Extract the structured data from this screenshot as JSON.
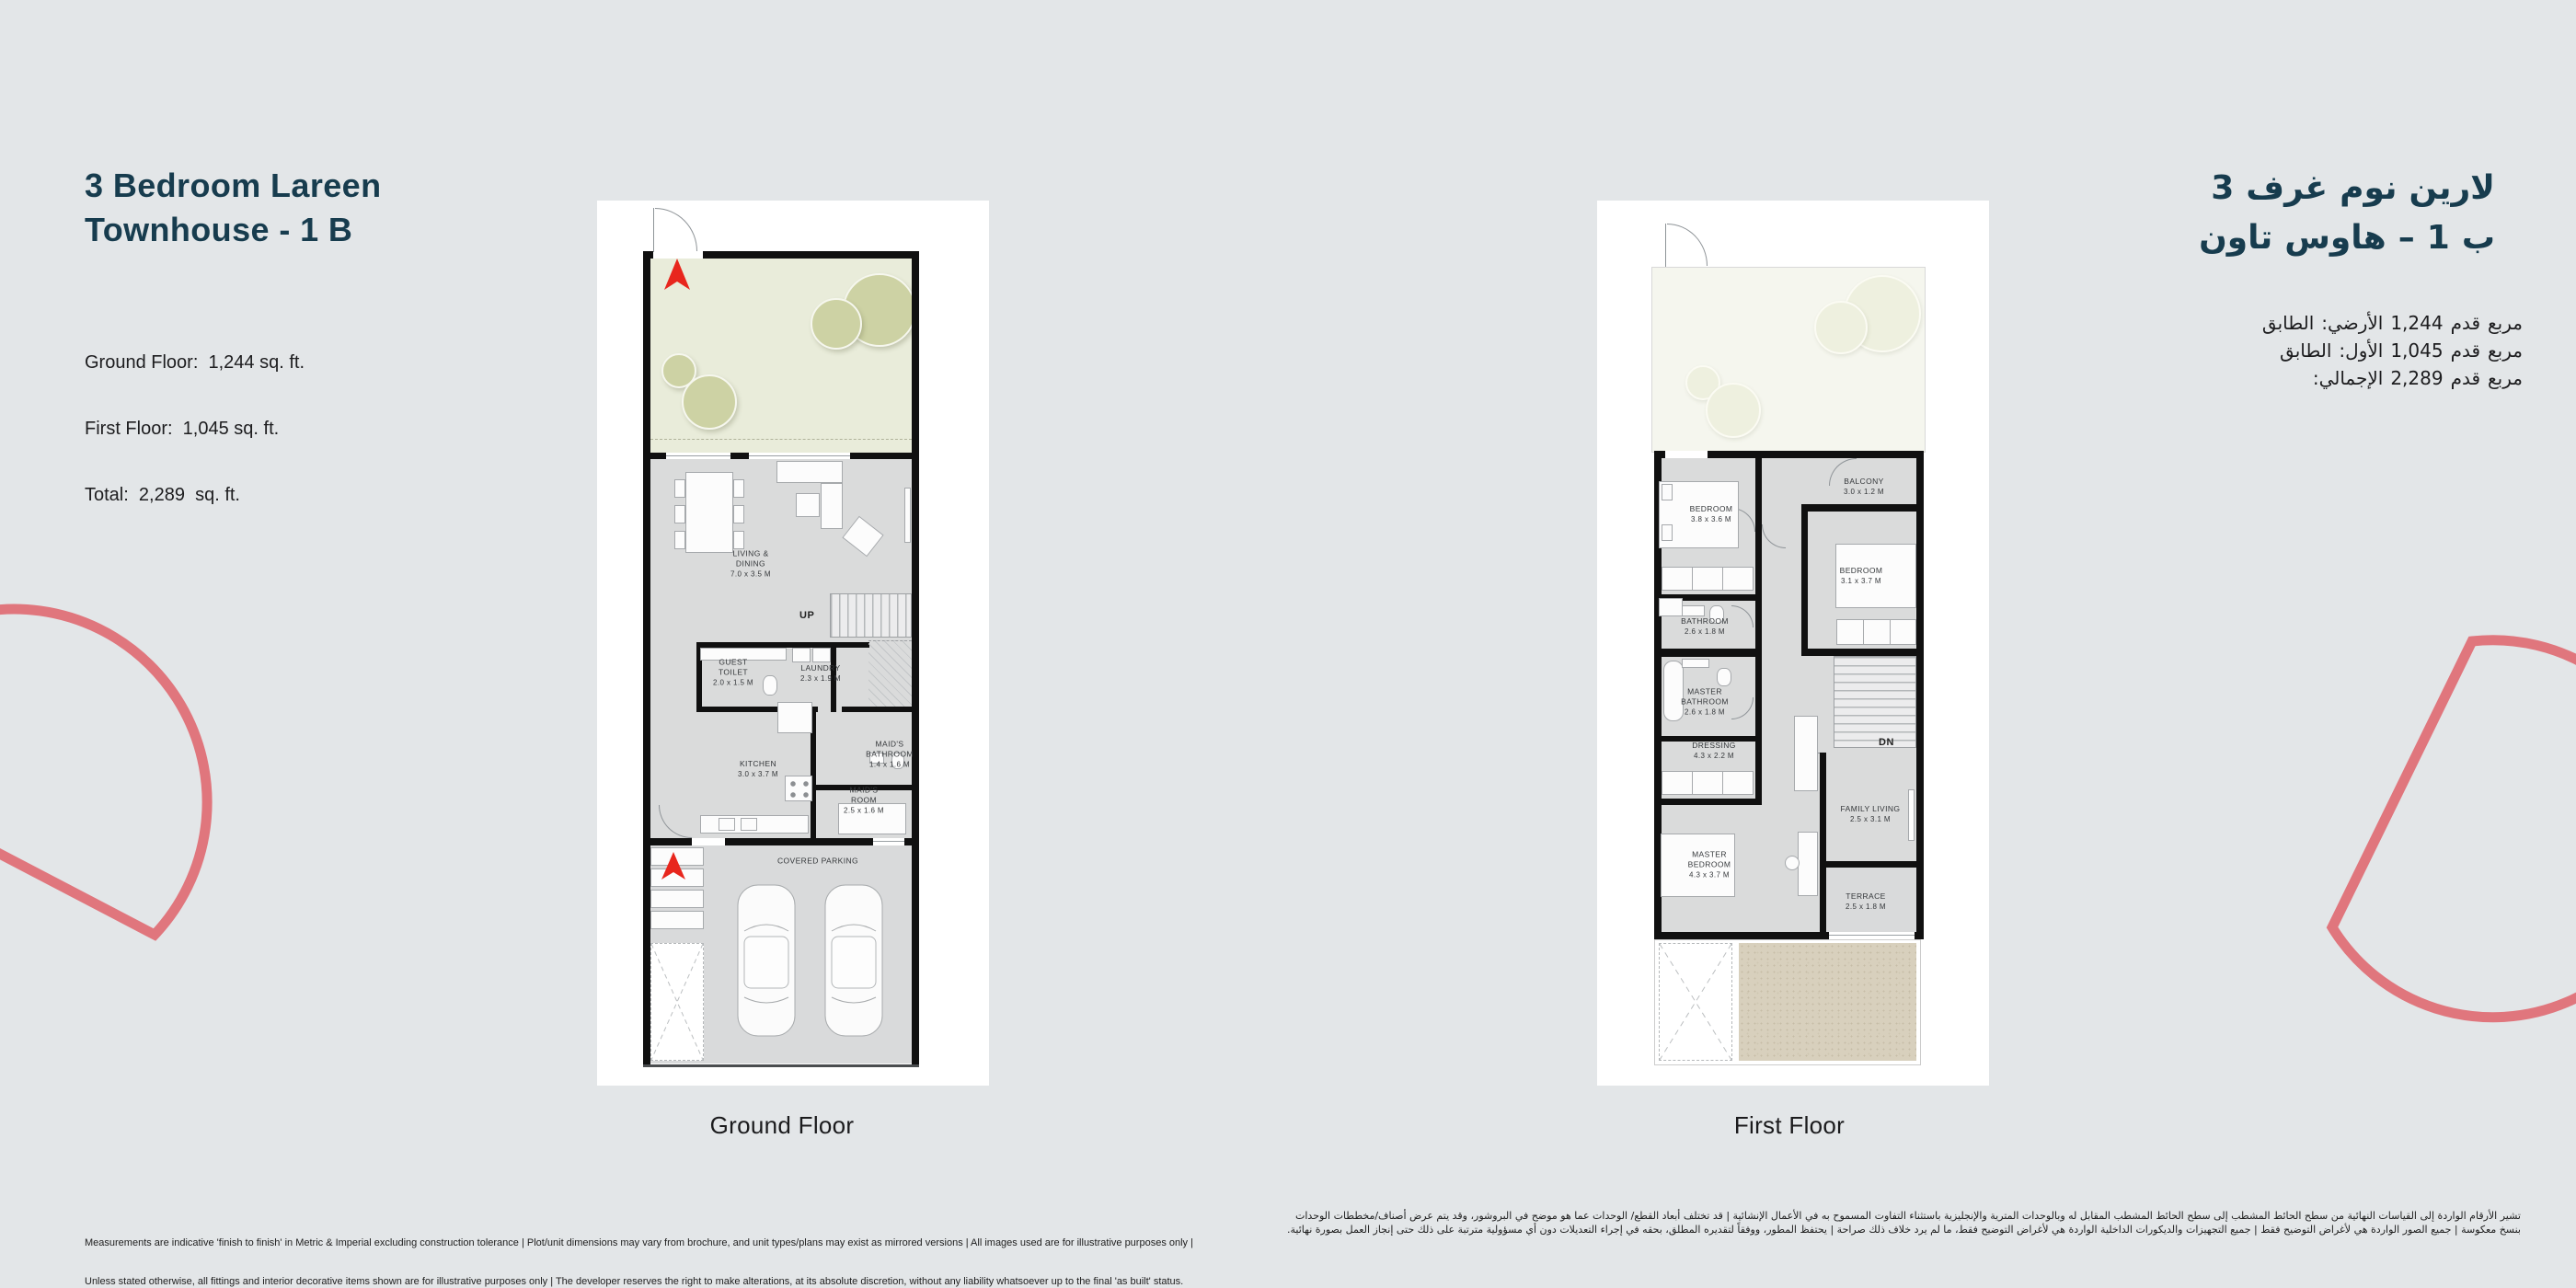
{
  "page": {
    "background": "#e3e6e8",
    "accent_coral": "#e0767d",
    "title_color": "#173c4e",
    "north_arrow_red": "#e8261d"
  },
  "header_en": {
    "title_line1": "3 Bedroom Lareen",
    "title_line2": "Townhouse - 1 B",
    "area_ground": "Ground Floor:  1,244 sq. ft.",
    "area_first": "First Floor:  1,045 sq. ft.",
    "area_total": "Total:  2,289  sq. ft."
  },
  "header_ar": {
    "title_line1_words": [
      "3",
      "غرف",
      "نوم",
      "لارين"
    ],
    "title_line2_words": [
      "تاون",
      "هاوس",
      "–",
      "1",
      "ب"
    ],
    "area_ground_words": [
      "الطابق",
      "الأرضي:",
      "1,244",
      "قدم",
      "مربع"
    ],
    "area_first_words": [
      "الطابق",
      "الأول:",
      "1,045",
      "قدم",
      "مربع"
    ],
    "area_total_words": [
      "الإجمالي:",
      "2,289",
      "قدم",
      "مربع"
    ]
  },
  "ground_floor": {
    "caption": "Ground Floor",
    "stairs_label": "UP",
    "rooms": {
      "living_dining": {
        "name": "LIVING & DINING",
        "dims": "7.0 x 3.5 M"
      },
      "guest_toilet": {
        "name": "GUEST TOILET",
        "dims": "2.0 x 1.5 M"
      },
      "laundry": {
        "name": "LAUNDRY",
        "dims": "2.3 x 1.9 M"
      },
      "kitchen": {
        "name": "KITCHEN",
        "dims": "3.0 x 3.7 M"
      },
      "maids_bathroom": {
        "name": "MAID'S BATHROOM",
        "dims": "1.4 x 1.6 M"
      },
      "maids_room": {
        "name": "MAID'S ROOM",
        "dims": "2.5 x 1.6 M"
      },
      "covered_parking": {
        "name": "COVERED PARKING"
      }
    }
  },
  "first_floor": {
    "caption": "First Floor",
    "stairs_label": "DN",
    "rooms": {
      "bedroom_1": {
        "name": "BEDROOM",
        "dims": "3.8 x 3.6 M"
      },
      "balcony": {
        "name": "BALCONY",
        "dims": "3.0 x 1.2 M"
      },
      "bedroom_2": {
        "name": "BEDROOM",
        "dims": "3.1 x 3.7 M"
      },
      "bathroom": {
        "name": "BATHROOM",
        "dims": "2.6 x 1.8 M"
      },
      "master_bathroom": {
        "name": "MASTER BATHROOM",
        "dims": "2.6 x 1.8 M"
      },
      "dressing": {
        "name": "DRESSING",
        "dims": "4.3 x 2.2 M"
      },
      "family_living": {
        "name": "FAMILY LIVING",
        "dims": "2.5 x 3.1 M"
      },
      "master_bedroom": {
        "name": "MASTER BEDROOM",
        "dims": "4.3 x 3.7 M"
      },
      "terrace": {
        "name": "TERRACE",
        "dims": "2.5 x 1.8 M"
      }
    }
  },
  "disclaimer_en": {
    "line1": "Measurements are indicative 'finish to finish' in Metric & Imperial excluding construction tolerance | Plot/unit dimensions may vary from brochure, and unit types/plans may exist as mirrored versions | All images used are for illustrative purposes only |",
    "line2": "Unless stated otherwise, all fittings and interior decorative items shown are for illustrative purposes only | The developer reserves the right to make alterations, at its absolute discretion, without any liability whatsoever up to the final 'as built' status."
  },
  "disclaimer_ar": {
    "line1": "تشير الأرقام الواردة إلى القياسات النهائية من سطح الحائط المشطب إلى سطح الحائط المشطب المقابل له وبالوحدات المترية والإنجليزية باستثناء التفاوت المسموح به في الأعمال الإنشائية | قد تختلف أبعاد القطع/ الوحدات عما هو موضح في البروشور، وقد يتم عرض أصناف/مخططات الوحدات",
    "line2": "بنسخ معكوسة | جميع الصور الواردة هي لأغراض التوضيح فقط | جميع التجهيزات والديكورات الداخلية الواردة هي لأغراض التوضيح فقط، ما لم يرد خلاف ذلك صراحة | يحتفظ المطور، ووفقاً لتقديره المطلق، بحقه في إجراء التعديلات دون أي مسؤولية مترتبة على ذلك حتى إنجاز العمل بصورة نهائية."
  }
}
